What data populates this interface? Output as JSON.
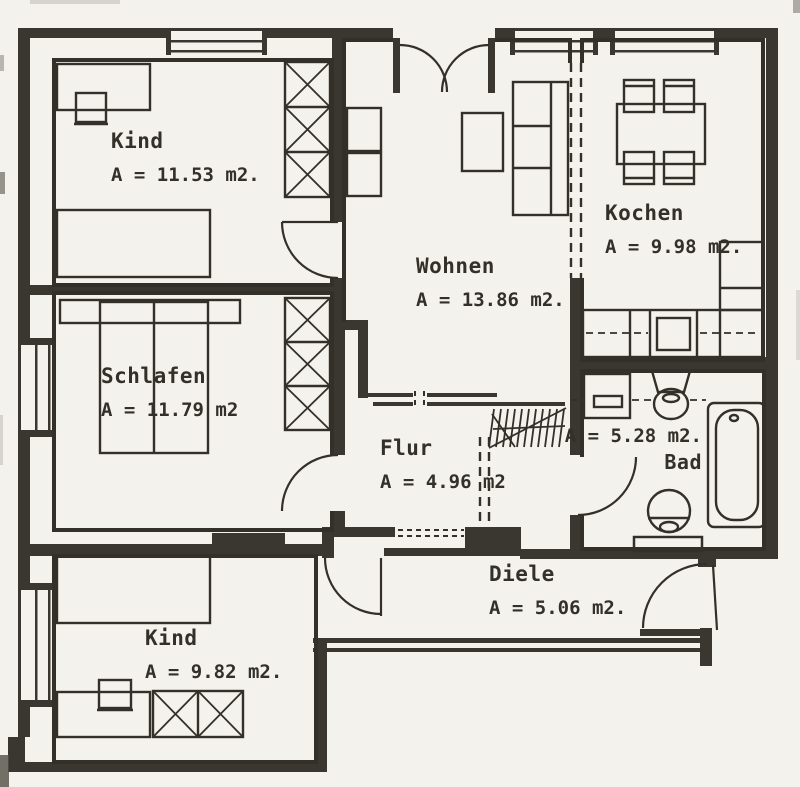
{
  "document": {
    "kind": "apartment-floor-plan"
  },
  "rooms": [
    {
      "id": "kind-1",
      "name": "Kind",
      "area": "A = 11.53 m2."
    },
    {
      "id": "wohnen",
      "name": "Wohnen",
      "area": "A = 13.86 m2."
    },
    {
      "id": "kochen",
      "name": "Kochen",
      "area": "A = 9.98 m2."
    },
    {
      "id": "schlafen",
      "name": "Schlafen",
      "area": "A = 11.79 m2"
    },
    {
      "id": "flur",
      "name": "Flur",
      "area": "A = 4.96 m2"
    },
    {
      "id": "bad",
      "name": "Bad",
      "area": "A = 5.28 m2."
    },
    {
      "id": "diele",
      "name": "Diele",
      "area": "A = 5.06 m2."
    },
    {
      "id": "kind-2",
      "name": "Kind",
      "area": "A = 9.82 m2."
    }
  ],
  "colors": {
    "ink": "#33302a",
    "wall": "#3a3731",
    "paper": "#f4f2ec"
  }
}
